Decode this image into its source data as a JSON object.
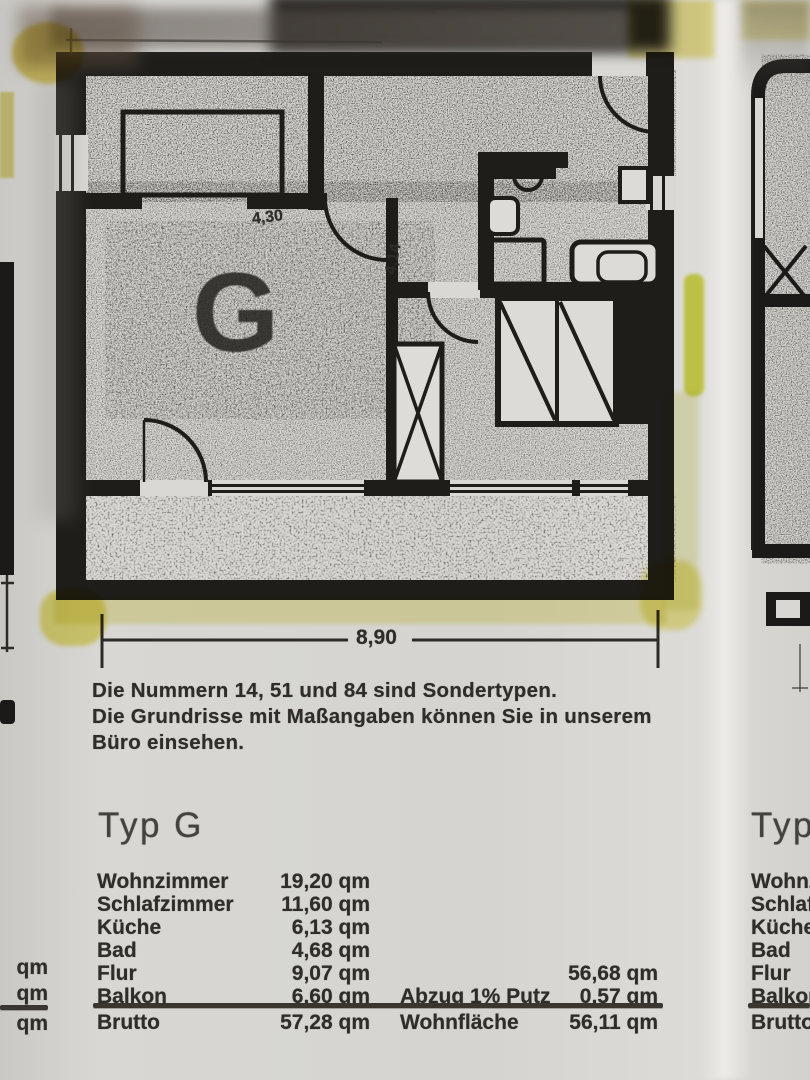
{
  "document": {
    "note_lines": [
      "Die Nummern 14, 51 und 84 sind Sondertypen.",
      "Die Grundrisse mit Maßangaben können Sie in unserem",
      "Büro einsehen."
    ],
    "type_heading": "Typ G",
    "plan": {
      "room_label": "G",
      "total_width": "8,90",
      "room_width": "4,30",
      "side_width": "4,14"
    },
    "area_table": {
      "unit": "qm",
      "rows": [
        {
          "label": "Wohnzimmer",
          "value": "19,20 qm"
        },
        {
          "label": "Schlafzimmer",
          "value": "11,60 qm"
        },
        {
          "label": "Küche",
          "value": "6,13 qm"
        },
        {
          "label": "Bad",
          "value": "4,68 qm"
        },
        {
          "label": "Flur",
          "value": "9,07 qm",
          "label2": "",
          "value2": "56,68 qm"
        },
        {
          "label": "Balkon",
          "value": "6,60 qm",
          "label2": "Abzug 1% Putz",
          "value2": "0,57 qm"
        },
        {
          "label": "Brutto",
          "value": "57,28 qm",
          "label2": "Wohnfläche",
          "value2": "56,11 qm"
        }
      ]
    },
    "right_column_partial": {
      "type_heading": "Typ",
      "labels": [
        "Wohnz",
        "Schlafz",
        "Küche",
        "Bad",
        "Flur",
        "Balkon",
        "Brutto"
      ]
    },
    "left_column_partial": {
      "values": [
        "qm",
        "qm",
        "qm"
      ]
    },
    "colors": {
      "ink": "#1e1d1a",
      "paper": "#d7d6d2",
      "highlighter_bright": "#d6de3f",
      "highlighter_pale": "#ece79c"
    }
  }
}
